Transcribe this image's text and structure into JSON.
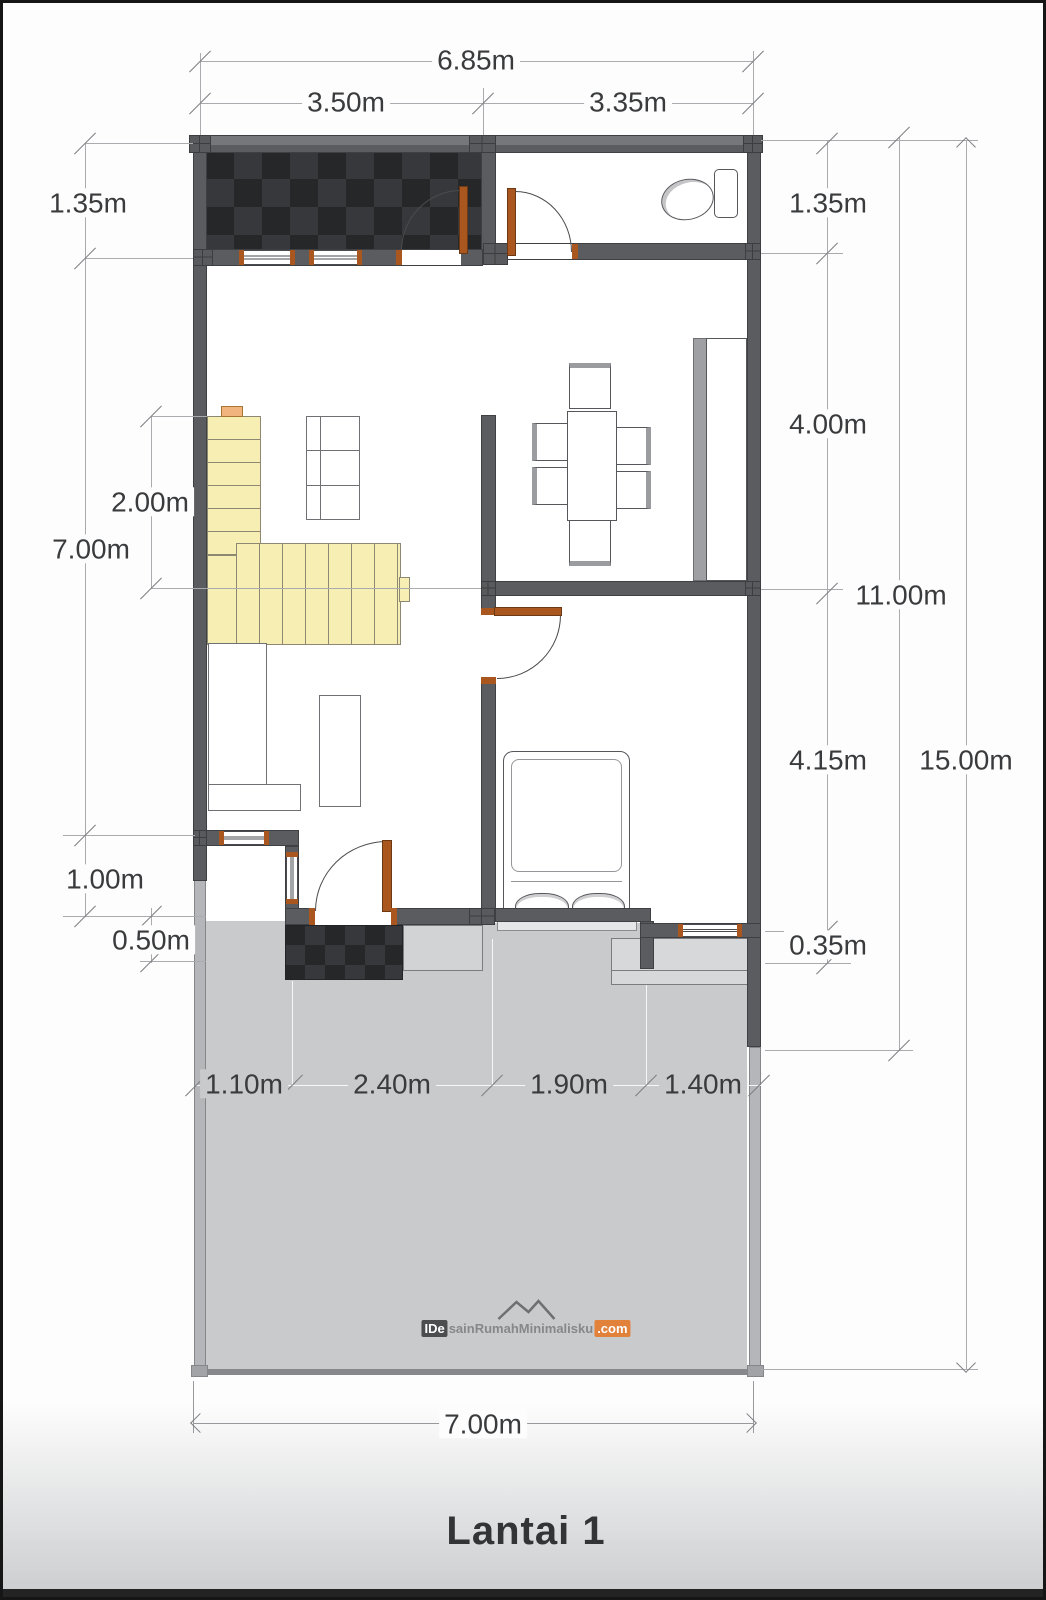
{
  "page": {
    "title": "Lantai 1"
  },
  "watermark": {
    "brand_prefix": "IDe",
    "brand_middle": "sainRumahMinimalisku",
    "brand_suffix": ".com"
  },
  "dimensions": {
    "top_total": "6.85m",
    "top_left_segment": "3.50m",
    "top_right_segment": "3.35m",
    "left_entry_depth": "1.35m",
    "right_entry_depth": "1.35m",
    "right_dining_depth": "4.00m",
    "left_stair_length": "2.00m",
    "left_house_depth": "7.00m",
    "right_house_depth": "11.00m",
    "right_bedroom_depth": "4.15m",
    "right_total_depth": "15.00m",
    "left_porch_depth": "1.00m",
    "left_step_depth": "0.50m",
    "right_step_depth": "0.35m",
    "bottom_segment_1": "1.10m",
    "bottom_segment_2": "2.40m",
    "bottom_segment_3": "1.90m",
    "bottom_segment_4": "1.40m",
    "bottom_total": "7.00m"
  },
  "colors": {
    "wall": "#5b5c5f",
    "dark_tile": "#2b2c2f",
    "stair": "#f6eeb2",
    "door_frame": "#a9571f",
    "yard": "#c9cacc",
    "dimension_text": "#3a3b3d",
    "watermark_accent": "#e2813a"
  }
}
